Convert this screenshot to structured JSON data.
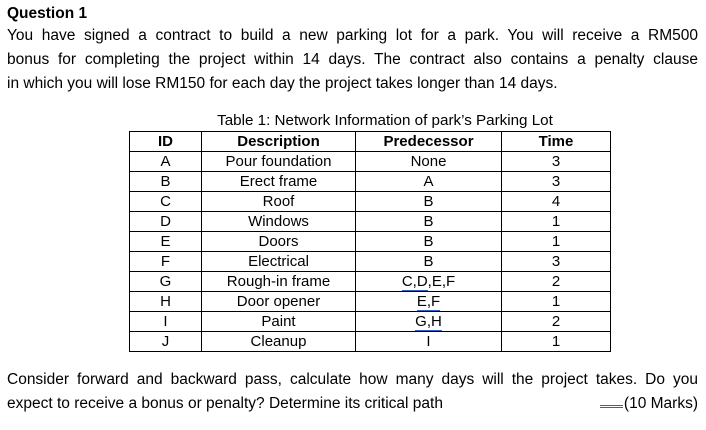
{
  "question": {
    "heading": "Question 1",
    "intro_lines": [
      "You have signed a contract to build a new parking lot for a park. You will receive a RM500",
      "bonus for completing the project within 14 days. The contract also contains a penalty clause",
      "in which you will lose RM150 for each day the project takes longer than 14 days."
    ]
  },
  "table": {
    "caption": "Table 1: Network Information of park’s Parking Lot",
    "headers": [
      "ID",
      "Description",
      "Predecessor",
      "Time"
    ],
    "rows": [
      {
        "id": "A",
        "description": "Pour foundation",
        "predecessor": [
          {
            "t": "None",
            "u": false
          }
        ],
        "time": "3"
      },
      {
        "id": "B",
        "description": "Erect frame",
        "predecessor": [
          {
            "t": "A",
            "u": false
          }
        ],
        "time": "3"
      },
      {
        "id": "C",
        "description": "Roof",
        "predecessor": [
          {
            "t": "B",
            "u": false
          }
        ],
        "time": "4"
      },
      {
        "id": "D",
        "description": "Windows",
        "predecessor": [
          {
            "t": "B",
            "u": false
          }
        ],
        "time": "1"
      },
      {
        "id": "E",
        "description": "Doors",
        "predecessor": [
          {
            "t": "B",
            "u": false
          }
        ],
        "time": "1"
      },
      {
        "id": "F",
        "description": "Electrical",
        "predecessor": [
          {
            "t": "B",
            "u": false
          }
        ],
        "time": "3"
      },
      {
        "id": "G",
        "description": "Rough-in frame",
        "predecessor": [
          {
            "t": "C,D",
            "u": true
          },
          {
            "t": ",E,F",
            "u": false
          }
        ],
        "time": "2"
      },
      {
        "id": "H",
        "description": "Door opener",
        "predecessor": [
          {
            "t": "E,F",
            "u": true
          }
        ],
        "time": "1"
      },
      {
        "id": "I",
        "description": "Paint",
        "predecessor": [
          {
            "t": "G,H",
            "u": true
          }
        ],
        "time": "2"
      },
      {
        "id": "J",
        "description": "Cleanup",
        "predecessor": [
          {
            "t": "I",
            "u": false
          }
        ],
        "time": "1"
      }
    ]
  },
  "outro": {
    "line1": "Consider forward and backward pass, calculate how many days will the project takes. Do you",
    "line2_left": "expect to receive a bonus or penalty? Determine its critical path",
    "marks": "(10 Marks)"
  },
  "colors": {
    "grammar_underline": "#3060C6",
    "text": "#000000",
    "background": "#FFFFFF"
  }
}
